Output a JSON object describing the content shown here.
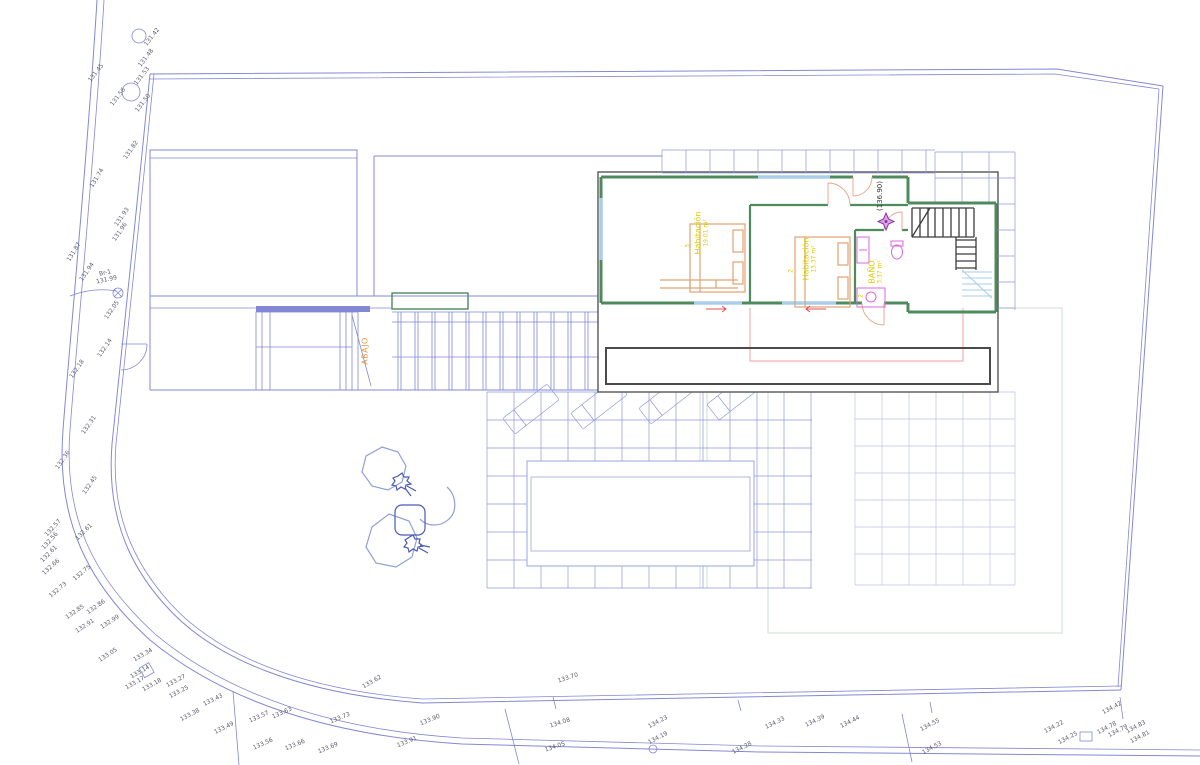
{
  "palette": {
    "line-blue": "#8288d4",
    "grid-blue": "#9098dc",
    "grid-blue-light": "#bcc3ec",
    "glazing-blue": "#a9cdeb",
    "wall-green": "#4d8a5c",
    "label-yellow": "#ddcb00",
    "furn-orange": "#e2a273",
    "fixture-magenta": "#dd66dd",
    "below-pink": "#f2b2b2",
    "stair-dark": "#3c3c3c",
    "door-salmon": "#eda98c",
    "accent-orange": "#e49b4a",
    "spot-text": "#5d5d6b",
    "star-purple": "#8d35a8",
    "tree-blue": "#8fa0d8",
    "tree-dark": "#4a5ab8",
    "faint-green": "#ccdcd2",
    "inset-border": "#565656",
    "red-arrow": "#e05050",
    "pool-edge": "#9aa4de"
  },
  "floor_plan": {
    "level_elevation": "(136.90)",
    "stair_note": "ABAJO",
    "rooms": [
      {
        "number": "3",
        "name": "Habitación",
        "area": "19.01 m²"
      },
      {
        "number": "2",
        "name": "Habitación",
        "area": "13.37 m²"
      },
      {
        "number": "2",
        "name": "BAÑO",
        "area": "3.37 m²"
      }
    ]
  },
  "site": {
    "benchmark": {
      "label": "Br-1",
      "value": "131.99"
    },
    "spot_elevations": [
      {
        "v": "131.42",
        "x": 152,
        "y": 37,
        "r": -52
      },
      {
        "v": "131.48",
        "x": 146,
        "y": 58,
        "r": -52
      },
      {
        "v": "131.45",
        "x": 96,
        "y": 73,
        "r": -52
      },
      {
        "v": "131.53",
        "x": 142,
        "y": 76,
        "r": -52
      },
      {
        "v": "131.56",
        "x": 118,
        "y": 97,
        "r": -52
      },
      {
        "v": "131.50",
        "x": 143,
        "y": 103,
        "r": -52
      },
      {
        "v": "131.82",
        "x": 131,
        "y": 150,
        "r": -55
      },
      {
        "v": "131.74",
        "x": 97,
        "y": 178,
        "r": -58
      },
      {
        "v": "131.93",
        "x": 122,
        "y": 217,
        "r": -55
      },
      {
        "v": "131.96",
        "x": 120,
        "y": 232,
        "r": -55
      },
      {
        "v": "131.87",
        "x": 74,
        "y": 252,
        "r": -58
      },
      {
        "v": "131.94",
        "x": 87,
        "y": 272,
        "r": -55
      },
      {
        "v": "132.05",
        "x": 112,
        "y": 310,
        "r": -55
      },
      {
        "v": "132.14",
        "x": 105,
        "y": 348,
        "r": -55
      },
      {
        "v": "132.18",
        "x": 77,
        "y": 369,
        "r": -55
      },
      {
        "v": "132.31",
        "x": 89,
        "y": 425,
        "r": -55
      },
      {
        "v": "132.36",
        "x": 63,
        "y": 460,
        "r": -55
      },
      {
        "v": "132.45",
        "x": 90,
        "y": 485,
        "r": -55
      },
      {
        "v": "132.57",
        "x": 53,
        "y": 528,
        "r": -48
      },
      {
        "v": "132.56",
        "x": 50,
        "y": 541,
        "r": -48
      },
      {
        "v": "132.61",
        "x": 49,
        "y": 554,
        "r": -45
      },
      {
        "v": "132.61",
        "x": 84,
        "y": 532,
        "r": -45
      },
      {
        "v": "132.66",
        "x": 51,
        "y": 567,
        "r": -42
      },
      {
        "v": "132.73",
        "x": 58,
        "y": 590,
        "r": -40
      },
      {
        "v": "132.75",
        "x": 82,
        "y": 573,
        "r": -40
      },
      {
        "v": "132.85",
        "x": 75,
        "y": 612,
        "r": -35
      },
      {
        "v": "132.86",
        "x": 96,
        "y": 607,
        "r": -35
      },
      {
        "v": "132.91",
        "x": 85,
        "y": 626,
        "r": -33
      },
      {
        "v": "132.99",
        "x": 110,
        "y": 622,
        "r": -33
      },
      {
        "v": "133.05",
        "x": 108,
        "y": 655,
        "r": -33
      },
      {
        "v": "133.34",
        "x": 143,
        "y": 655,
        "r": -30
      },
      {
        "v": "133.14",
        "x": 140,
        "y": 672,
        "r": -30
      },
      {
        "v": "133.17",
        "x": 135,
        "y": 683,
        "r": -30
      },
      {
        "v": "133.18",
        "x": 152,
        "y": 685,
        "r": -30
      },
      {
        "v": "133.27",
        "x": 176,
        "y": 681,
        "r": -28
      },
      {
        "v": "133.25",
        "x": 179,
        "y": 692,
        "r": -28
      },
      {
        "v": "133.38",
        "x": 190,
        "y": 715,
        "r": -28
      },
      {
        "v": "133.43",
        "x": 213,
        "y": 700,
        "r": -26
      },
      {
        "v": "133.49",
        "x": 224,
        "y": 728,
        "r": -26
      },
      {
        "v": "133.57",
        "x": 259,
        "y": 717,
        "r": -24
      },
      {
        "v": "133.63",
        "x": 282,
        "y": 713,
        "r": -24
      },
      {
        "v": "133.73",
        "x": 340,
        "y": 718,
        "r": -22
      },
      {
        "v": "133.56",
        "x": 263,
        "y": 744,
        "r": -24
      },
      {
        "v": "133.66",
        "x": 295,
        "y": 745,
        "r": -22
      },
      {
        "v": "133.69",
        "x": 328,
        "y": 748,
        "r": -22
      },
      {
        "v": "133.62",
        "x": 372,
        "y": 682,
        "r": -30
      },
      {
        "v": "133.70",
        "x": 568,
        "y": 678,
        "r": -18
      },
      {
        "v": "133.90",
        "x": 430,
        "y": 720,
        "r": -22
      },
      {
        "v": "133.91",
        "x": 407,
        "y": 742,
        "r": -22
      },
      {
        "v": "134.08",
        "x": 560,
        "y": 723,
        "r": -18
      },
      {
        "v": "134.05",
        "x": 555,
        "y": 747,
        "r": -18
      },
      {
        "v": "134.23",
        "x": 658,
        "y": 722,
        "r": -28
      },
      {
        "v": "134.19",
        "x": 658,
        "y": 738,
        "r": -28
      },
      {
        "v": "134.28",
        "x": 742,
        "y": 748,
        "r": -26
      },
      {
        "v": "134.33",
        "x": 775,
        "y": 723,
        "r": -26
      },
      {
        "v": "134.39",
        "x": 815,
        "y": 721,
        "r": -26
      },
      {
        "v": "134.44",
        "x": 850,
        "y": 722,
        "r": -26
      },
      {
        "v": "134.55",
        "x": 930,
        "y": 725,
        "r": -28
      },
      {
        "v": "134.53",
        "x": 932,
        "y": 748,
        "r": -28
      },
      {
        "v": "134.22",
        "x": 1054,
        "y": 727,
        "r": -28
      },
      {
        "v": "134.25",
        "x": 1068,
        "y": 738,
        "r": -28
      },
      {
        "v": "134.42",
        "x": 1112,
        "y": 708,
        "r": -28
      },
      {
        "v": "134.78",
        "x": 1107,
        "y": 728,
        "r": -28
      },
      {
        "v": "134.79",
        "x": 1118,
        "y": 731,
        "r": -28
      },
      {
        "v": "134.83",
        "x": 1136,
        "y": 727,
        "r": -28
      },
      {
        "v": "134.81",
        "x": 1140,
        "y": 737,
        "r": -28
      }
    ]
  }
}
